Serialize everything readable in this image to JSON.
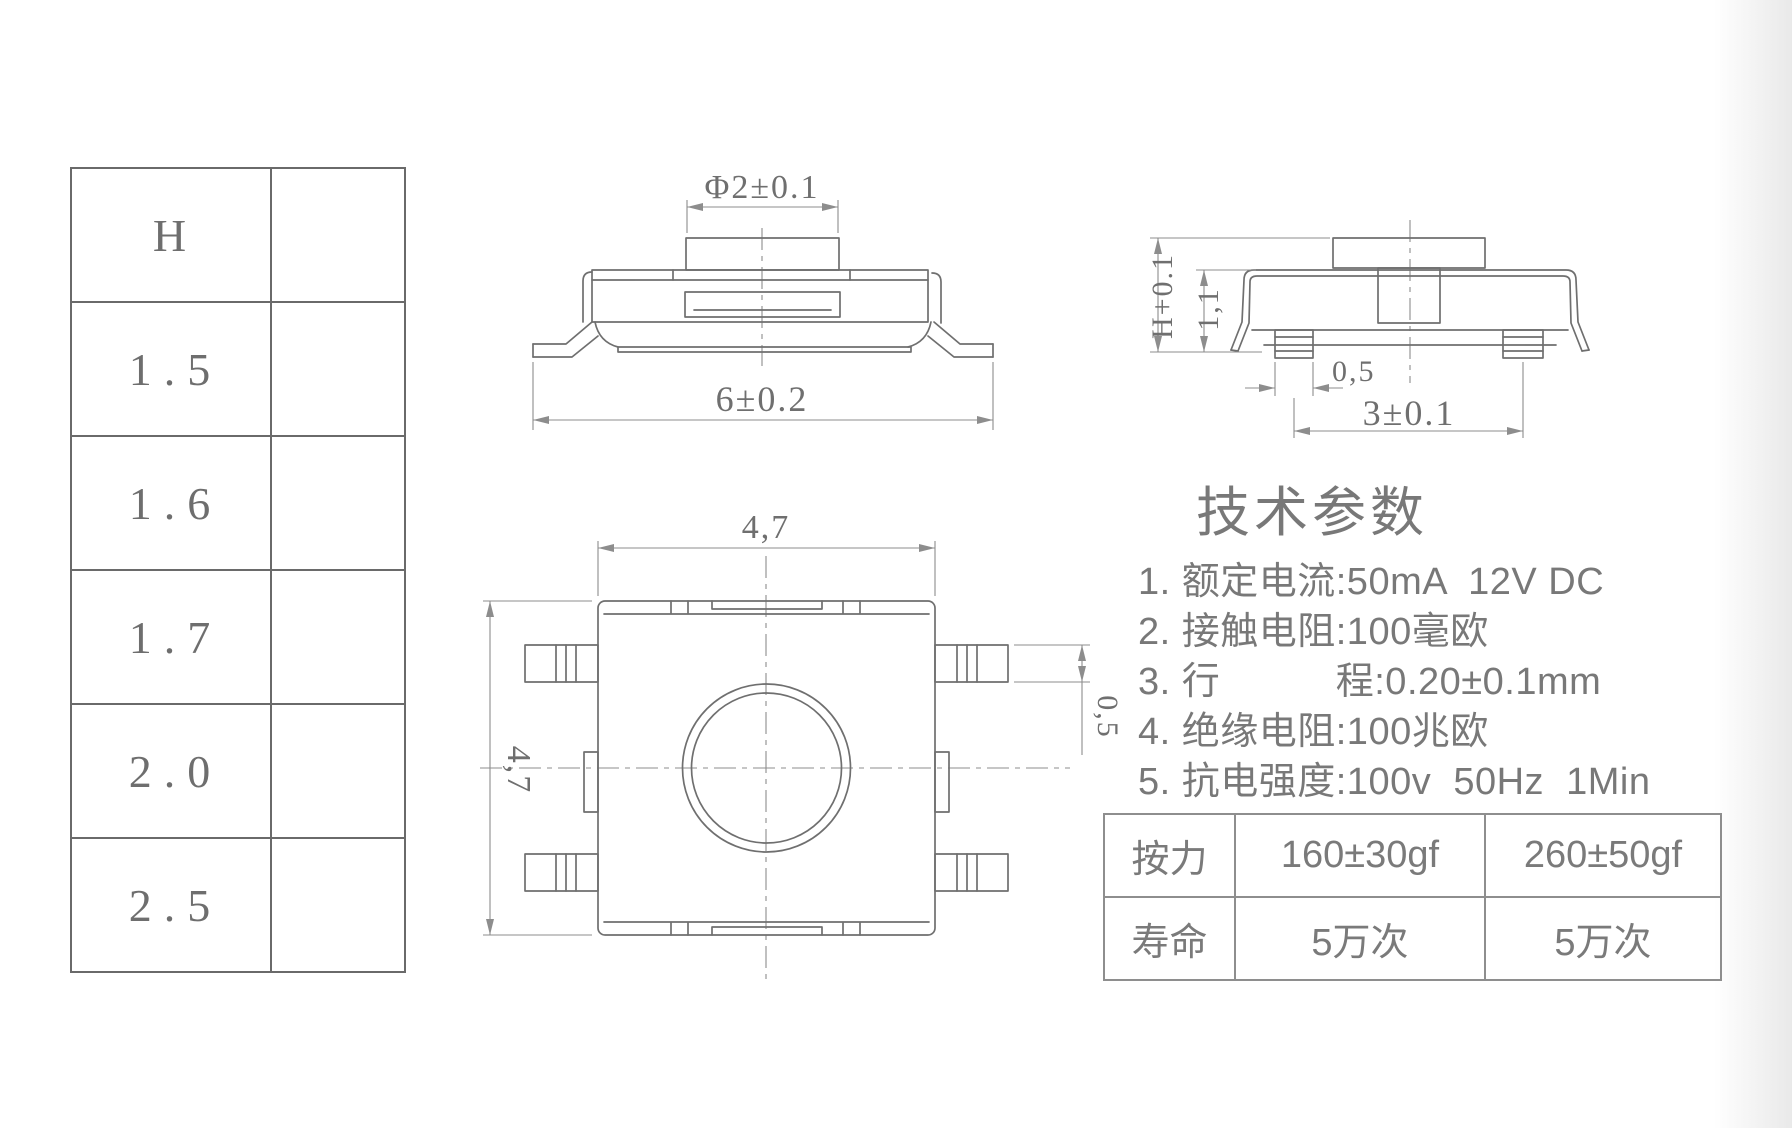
{
  "window": {
    "background": "#ffffff",
    "line_color": "#6f6f6f"
  },
  "h_table": {
    "header": "H",
    "rows": [
      "1.5",
      "1.6",
      "1.7",
      "2.0",
      "2.5"
    ]
  },
  "side_view": {
    "dim_button_diameter": "Φ2±0.1",
    "dim_body_width": "6±0.2"
  },
  "front_view": {
    "dim_total_height": "H+0.1",
    "dim_body_height": "1,1",
    "dim_leg_width": "0,5",
    "dim_leg_pitch": "3±0.1"
  },
  "top_view": {
    "dim_width": "4,7",
    "dim_height": "4,7",
    "dim_leg_thickness": "0,5"
  },
  "tech_params": {
    "title": "技术参数",
    "items": [
      "1. 额定电流:50mA  12V DC",
      "2. 接触电阻:100毫欧",
      "3. 行　　　程:0.20±0.1mm",
      "4. 绝缘电阻:100兆欧",
      "5. 抗电强度:100v  50Hz  1Min"
    ]
  },
  "spec_table": {
    "rows": [
      {
        "label": "按力",
        "value1": "160±30gf",
        "value2": "260±50gf"
      },
      {
        "label": "寿命",
        "value1": "5万次",
        "value2": "5万次"
      }
    ]
  }
}
